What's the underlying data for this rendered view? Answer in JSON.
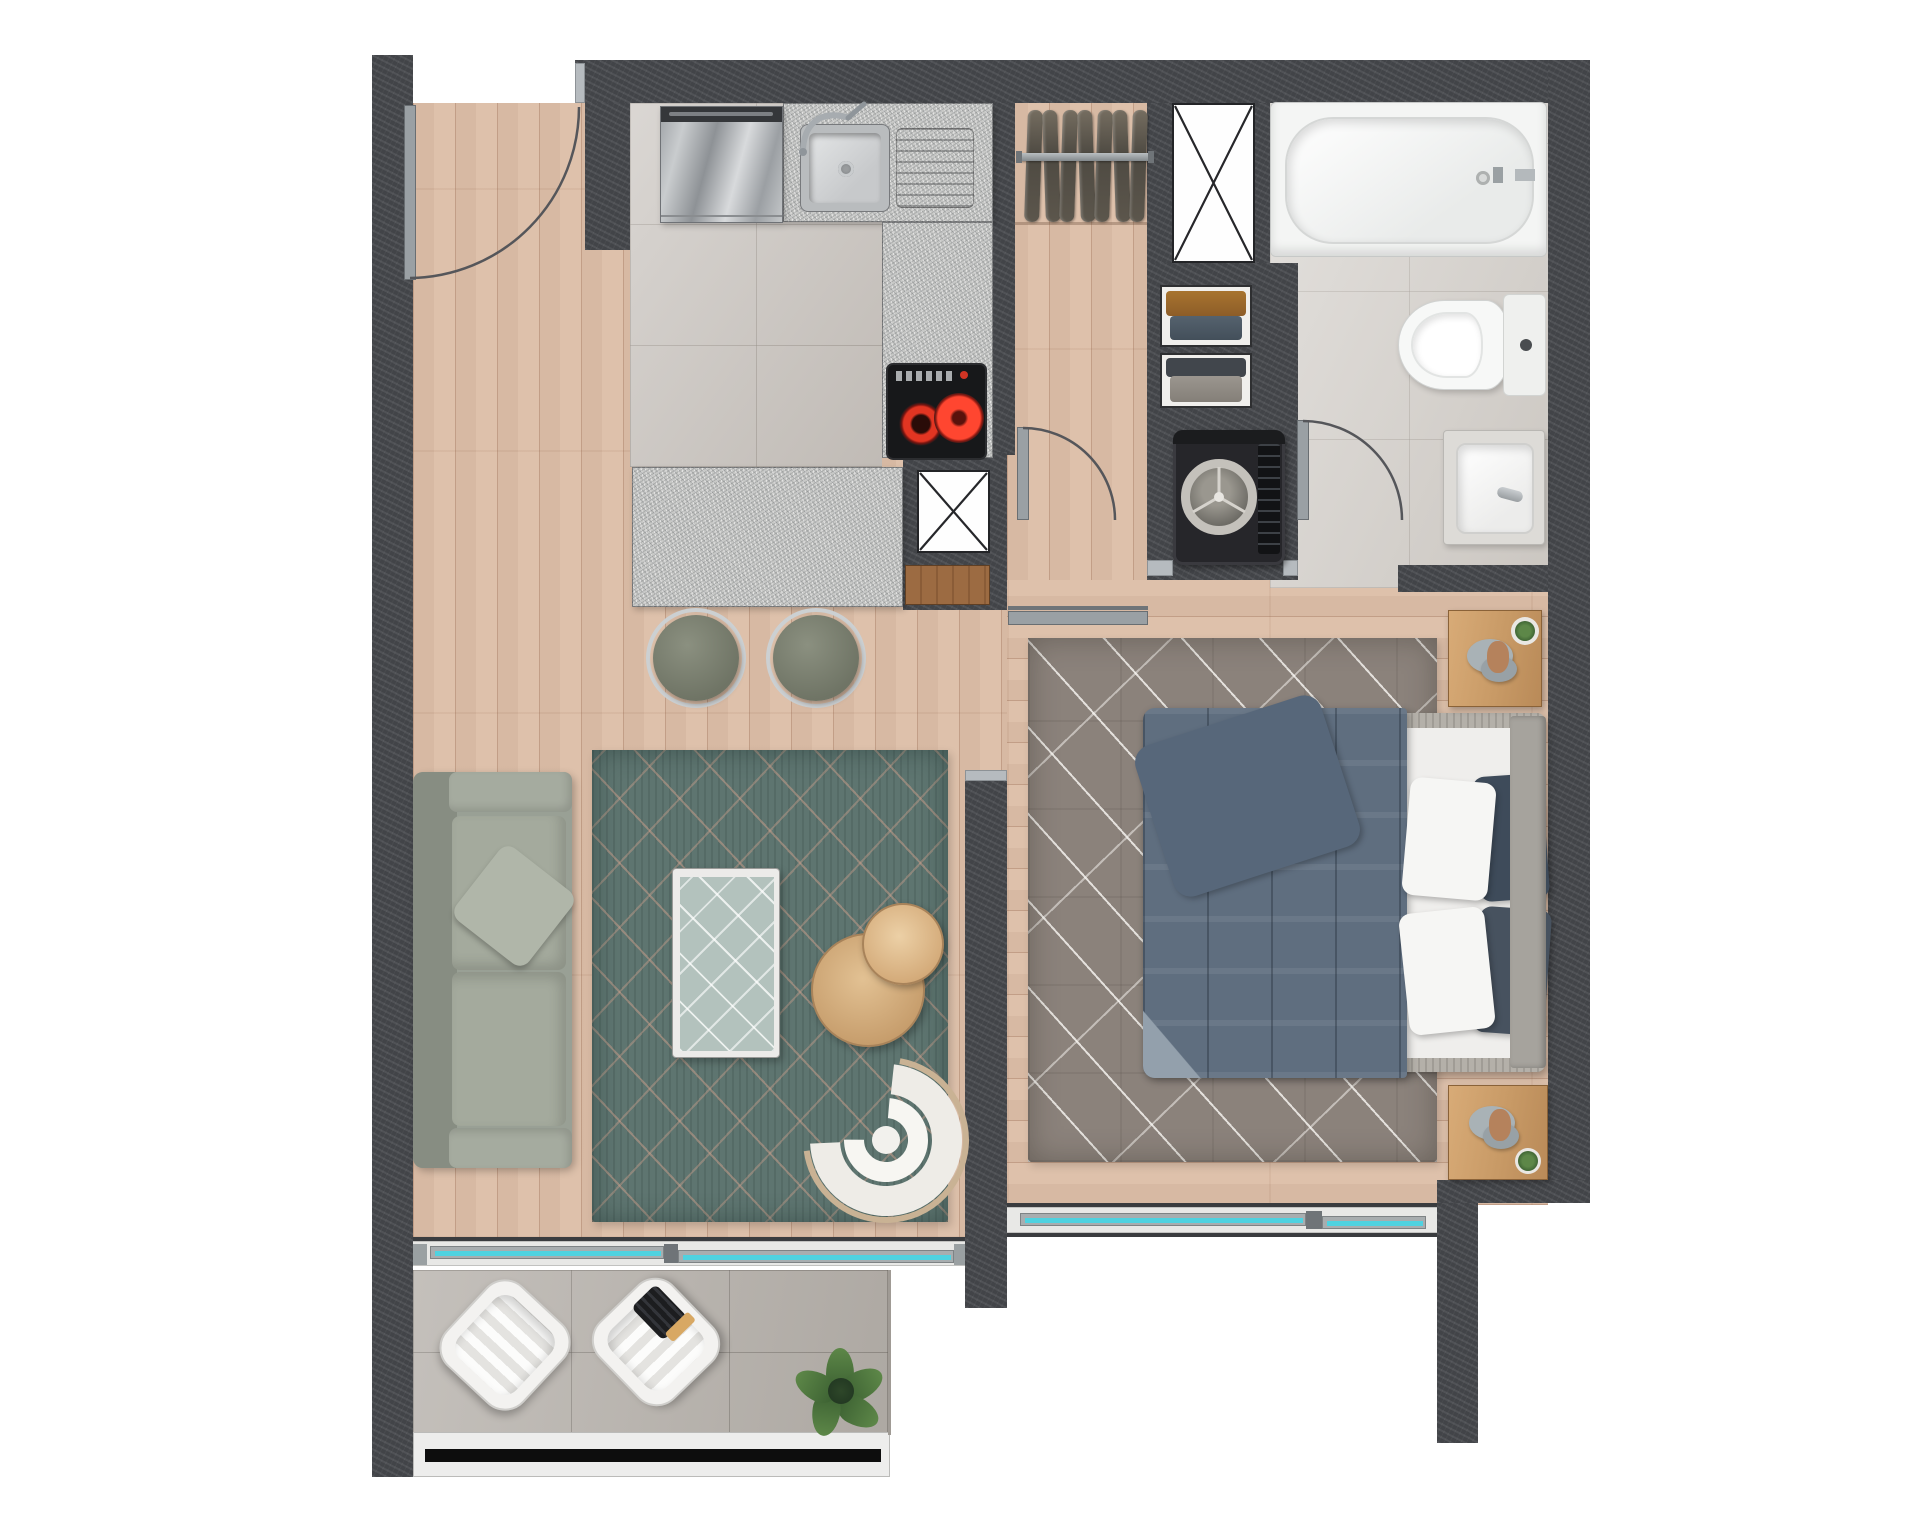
{
  "meta": {
    "type": "apartment-floor-plan",
    "view": "top-down-render",
    "units_text_visible": false
  },
  "palette": {
    "wall": "#47494d",
    "wood_floor": "#dcc0ab",
    "kitchen_tile": "#ccc7c2",
    "bathroom_tile": "#d7d3ce",
    "balcony_tile": "#b7b2ac",
    "granite": "#c8c9c7",
    "living_rug": "#5e7570",
    "bedroom_rug": "#8b827b",
    "duvet": "#5f6e7f",
    "sofa": "#99a095",
    "window_glass": "#4fd2e0",
    "railing_stripe": "#0d0d0d"
  },
  "rooms": {
    "entry": {
      "label": "Entry hall"
    },
    "kitchen": {
      "label": "Kitchen"
    },
    "closet": {
      "label": "Closet",
      "hanging_items": 7
    },
    "hallway": {
      "label": "Hallway"
    },
    "bathroom": {
      "label": "Bathroom"
    },
    "laundry": {
      "label": "Laundry niche"
    },
    "living_room": {
      "label": "Living room"
    },
    "bedroom": {
      "label": "Bedroom"
    },
    "balcony": {
      "label": "Balcony"
    }
  },
  "furniture": {
    "entry_door": {
      "label": "Entry door (swing)"
    },
    "fridge": {
      "label": "Refrigerator"
    },
    "sink": {
      "label": "Kitchen sink"
    },
    "drainboard": {
      "label": "Drainboard"
    },
    "stove": {
      "label": "Two-burner cooktop"
    },
    "island": {
      "label": "Kitchen island counter"
    },
    "bar_stools": {
      "label": "Bar stools",
      "count": 2
    },
    "shaft_top": {
      "label": "Service shaft"
    },
    "shaft_kitchen": {
      "label": "Service shaft"
    },
    "shoe_cabinet": {
      "label": "Low wooden cabinet"
    },
    "wardrobe_rod": {
      "label": "Closet hanging rail"
    },
    "shelf_unit": {
      "label": "Linen shelves with folded clothes"
    },
    "washing_machine": {
      "label": "Top-load washing machine"
    },
    "bathtub": {
      "label": "Bathtub"
    },
    "toilet": {
      "label": "Toilet"
    },
    "washbasin": {
      "label": "Washbasin vanity"
    },
    "hall_door": {
      "label": "Hall door (swing)"
    },
    "bathroom_door": {
      "label": "Bathroom door (swing)"
    },
    "sliding_door": {
      "label": "Sliding door panel"
    },
    "sofa": {
      "label": "Three-seat sofa"
    },
    "living_rug": {
      "label": "Patterned living room rug"
    },
    "coffee_table": {
      "label": "Glass coffee table"
    },
    "side_tables": {
      "label": "Round wooden side tables",
      "count": 2
    },
    "armchair": {
      "label": "Curved armchair"
    },
    "bed": {
      "label": "Double bed"
    },
    "nightstand_top": {
      "label": "Nightstand with plant and stones"
    },
    "nightstand_bottom": {
      "label": "Nightstand with plant and stones"
    },
    "bedroom_rug": {
      "label": "Bedroom rug"
    },
    "balcony_glazing": {
      "label": "Balcony sliding glass door"
    },
    "bedroom_window": {
      "label": "Bedroom sliding window"
    },
    "railing": {
      "label": "Balcony railing"
    },
    "balcony_chairs": {
      "label": "Balcony lounge chairs",
      "count": 2
    },
    "balcony_plant": {
      "label": "Potted plant"
    }
  }
}
